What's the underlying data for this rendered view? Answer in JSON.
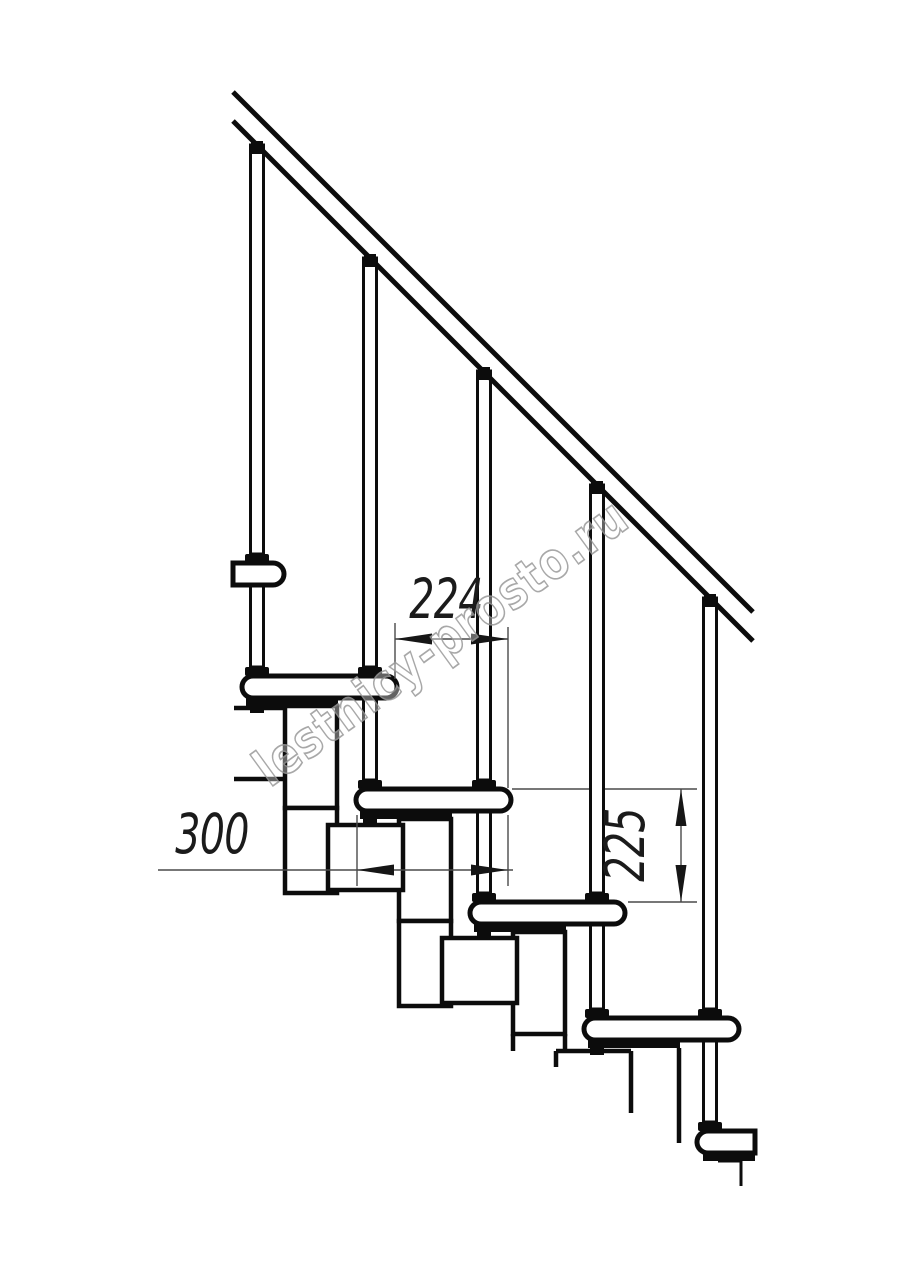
{
  "drawing": {
    "kind": "modular-staircase-side-view",
    "dimensions": {
      "going": "224",
      "tread_depth": "300",
      "rise": "225"
    },
    "watermark": "lestnicy-prosto.ru",
    "colors": {
      "line": "#0c0c0c",
      "dim_line": "#4a4a4a",
      "dim_text": "#1b1b1b",
      "watermark": "#9a9a9a",
      "background": "#ffffff"
    }
  }
}
